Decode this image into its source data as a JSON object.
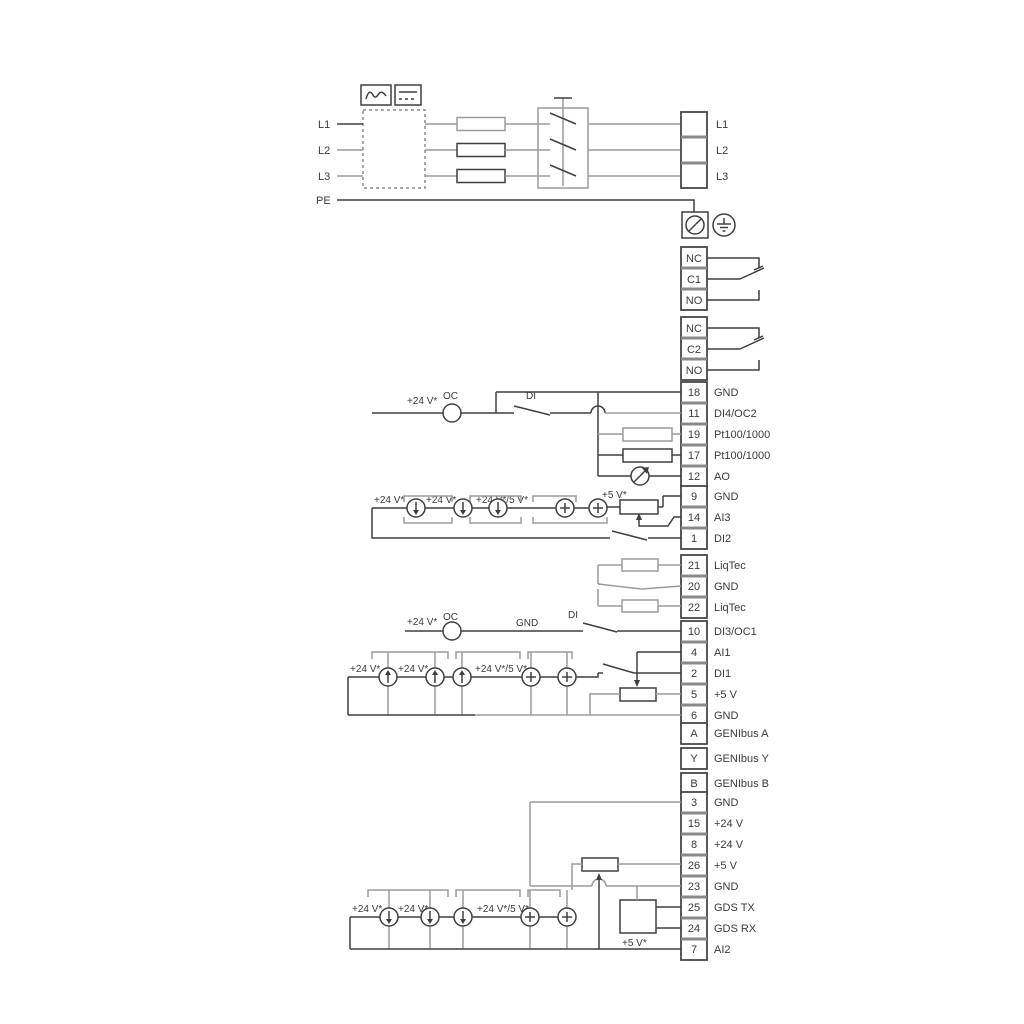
{
  "power": {
    "labels": [
      "L1",
      "L2",
      "L3",
      "PE"
    ],
    "out": [
      "L1",
      "L2",
      "L3"
    ]
  },
  "relay1": {
    "nc": "NC",
    "c": "C1",
    "no": "NO"
  },
  "relay2": {
    "nc": "NC",
    "c": "C2",
    "no": "NO"
  },
  "groups": {
    "g1": [
      {
        "num": "18",
        "label": "GND"
      },
      {
        "num": "11",
        "label": "DI4/OC2"
      },
      {
        "num": "19",
        "label": "Pt100/1000"
      },
      {
        "num": "17",
        "label": "Pt100/1000"
      },
      {
        "num": "12",
        "label": "AO"
      }
    ],
    "g2": [
      {
        "num": "9",
        "label": "GND"
      },
      {
        "num": "14",
        "label": "AI3"
      },
      {
        "num": "1",
        "label": "DI2"
      }
    ],
    "g3": [
      {
        "num": "21",
        "label": "LiqTec"
      },
      {
        "num": "20",
        "label": "GND"
      },
      {
        "num": "22",
        "label": "LiqTec"
      }
    ],
    "g4": [
      {
        "num": "10",
        "label": "DI3/OC1"
      },
      {
        "num": "4",
        "label": "AI1"
      },
      {
        "num": "2",
        "label": "DI1"
      },
      {
        "num": "5",
        "label": "+5 V"
      },
      {
        "num": "6",
        "label": "GND"
      }
    ],
    "g5": [
      {
        "num": "A",
        "label": "GENIbus A"
      },
      {
        "num": "Y",
        "label": "GENIbus Y"
      },
      {
        "num": "B",
        "label": "GENIbus B"
      }
    ],
    "g6": [
      {
        "num": "3",
        "label": "GND"
      },
      {
        "num": "15",
        "label": "+24 V"
      },
      {
        "num": "8",
        "label": "+24 V"
      },
      {
        "num": "26",
        "label": "+5 V"
      },
      {
        "num": "23",
        "label": "GND"
      },
      {
        "num": "25",
        "label": "GDS TX"
      },
      {
        "num": "24",
        "label": "GDS RX"
      },
      {
        "num": "7",
        "label": "AI2"
      }
    ]
  },
  "ann": {
    "v24": "+24 V*",
    "oc": "OC",
    "di": "DI",
    "gnd": "GND",
    "v24_5": "+24 V*/5 V*",
    "v5": "+5 V*"
  },
  "colors": {
    "wire_gray": "#9b9b9b",
    "wire_dark": "#3f3f3f",
    "text": "#3a3a3a",
    "background": "#ffffff"
  }
}
